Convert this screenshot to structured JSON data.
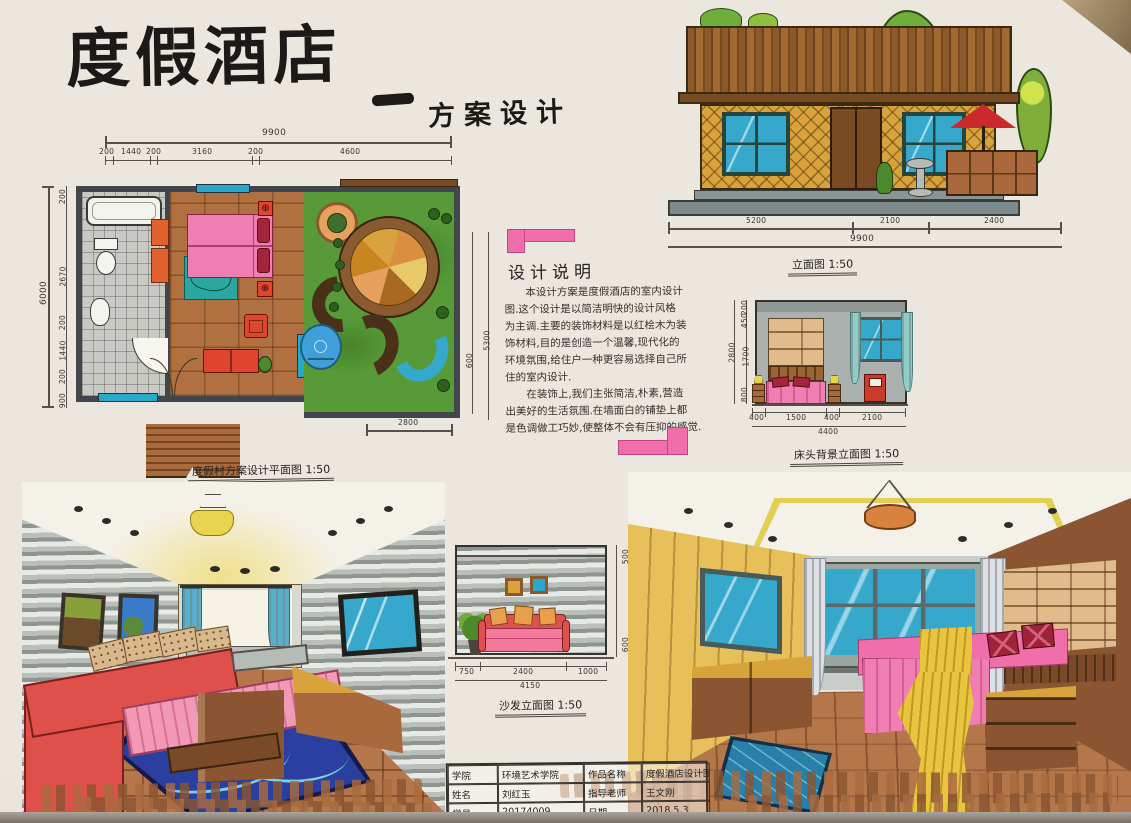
{
  "palette": {
    "paper": "#ebe6de",
    "ink": "#26221e",
    "pink_accent": "#f06eaa",
    "marker_pink": "#ef7fb2",
    "marker_red": "#e0473a",
    "marker_orange": "#e2622f",
    "marker_green": "#579a37",
    "marker_dark_green": "#2f5f1f",
    "marker_blue": "#35a8cc",
    "marker_navy": "#2a3fa0",
    "marker_teal": "#2aa8a0",
    "marker_wood": "#a9693c",
    "marker_wood_dark": "#7a4a22",
    "marker_tan": "#d9a33c",
    "marker_gray": "#a7adab",
    "wall_slate": "#41464a",
    "lamp_yellow": "#e8d44f"
  },
  "title": {
    "main": "度假酒店",
    "dash": "—",
    "subtitle": "方案设计"
  },
  "floor_plan": {
    "caption": "度假村方案设计平面图 1:50",
    "dim_top_total": "9900",
    "dim_top": [
      "200",
      "1440",
      "200",
      "3160",
      "200",
      "4600"
    ],
    "dim_left_total": "6000",
    "dim_left": [
      "200",
      "2670",
      "200",
      "1440",
      "200",
      "900"
    ],
    "dim_right_outer": "5300",
    "dim_right_inner": "600",
    "dim_bottom": "2800"
  },
  "building_elevation": {
    "caption": "立面图 1:50",
    "dim_total": "9900",
    "dim_segments": [
      "5200",
      "2100",
      "2400"
    ]
  },
  "design_notes": {
    "heading": "设计说明",
    "lines": [
      "　　本设计方案是度假酒店的室内设计",
      "图.这个设计是以简洁明快的设计风格",
      "为主调.主要的装饰材料是以红桧木为装",
      "饰材料,目的是创造一个温馨,现代化的",
      "环境氛围,给住户一种更容易选择自己所",
      "住的室内设计.",
      "　　在装饰上,我们主张简洁,朴素,营造",
      "出美好的生活氛围.在墙面白的铺垫上都",
      "是色调做工巧妙,使整体不会有压抑的感觉."
    ]
  },
  "bed_elevation": {
    "caption": "床头背景立面图 1:50",
    "dim_bottom": [
      "400",
      "1500",
      "400",
      "2100"
    ],
    "dim_bottom_total": "4400",
    "dim_left": [
      "200",
      "450",
      "1700",
      "800"
    ],
    "dim_left_total": "2800"
  },
  "sofa_elevation": {
    "caption": "沙发立面图 1:50",
    "dim_bottom": [
      "750",
      "2400",
      "1000"
    ],
    "dim_bottom_total": "4150",
    "dim_right": [
      "500",
      "600"
    ]
  },
  "title_block": {
    "rows": [
      [
        "学院",
        "环境艺术学院",
        "作品名称",
        "度假酒店设计图"
      ],
      [
        "姓名",
        "刘红玉",
        "指导老师",
        "王文刚"
      ],
      [
        "学号",
        "20174009",
        "日期",
        "2018.5.3"
      ]
    ]
  }
}
